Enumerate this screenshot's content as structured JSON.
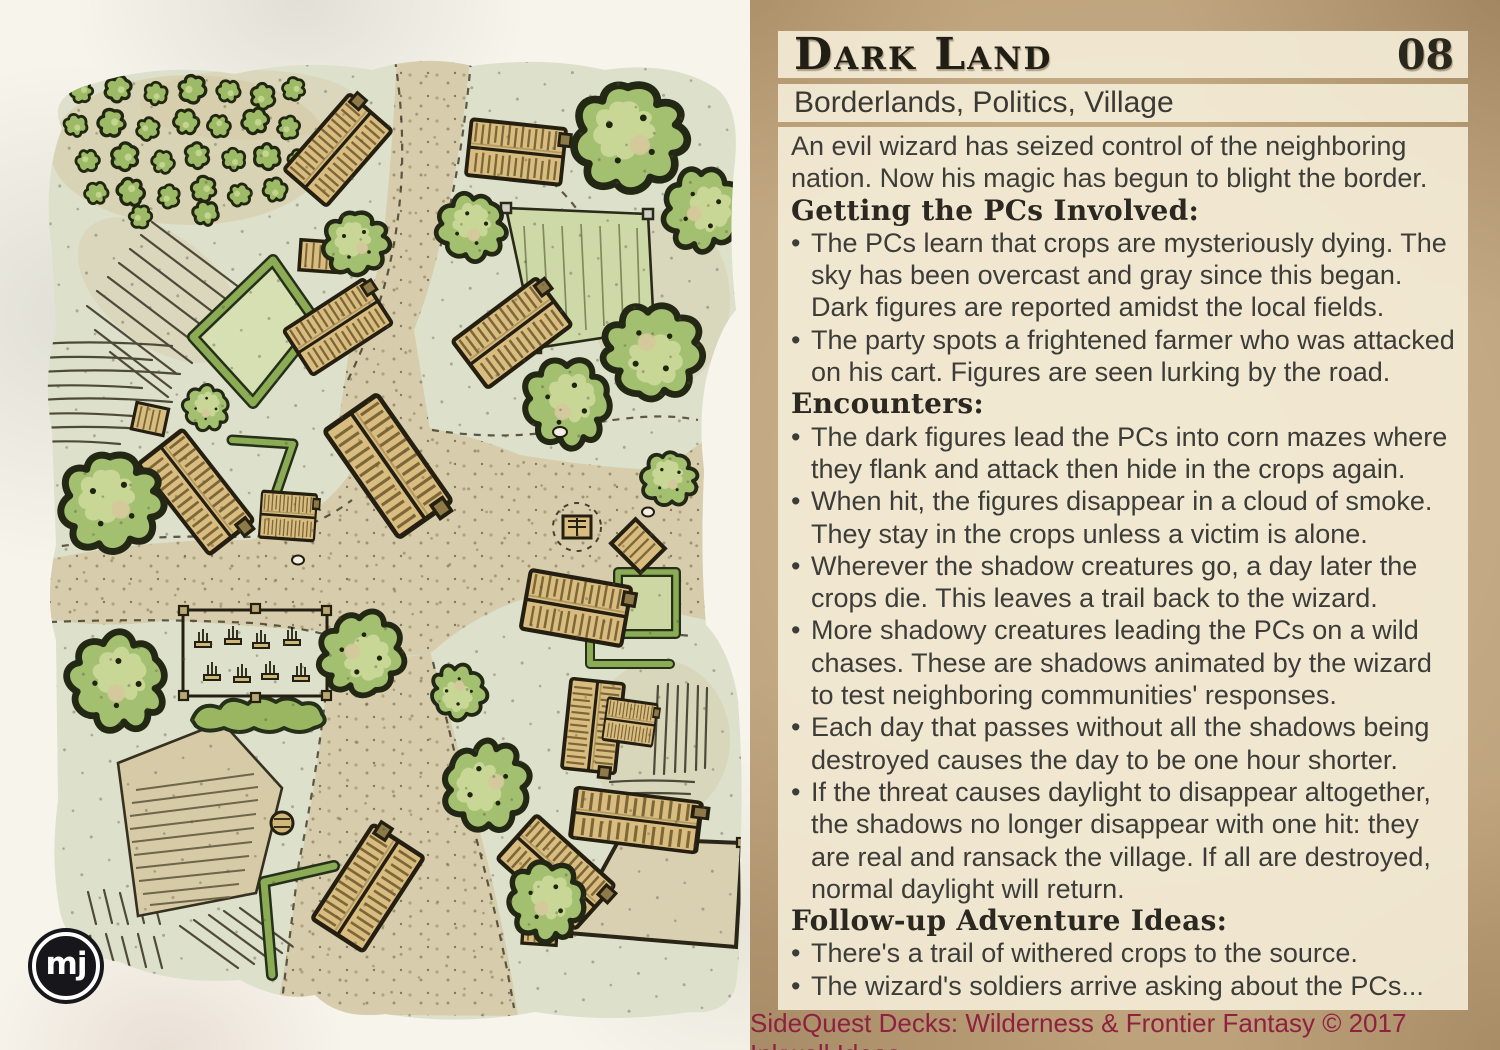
{
  "card": {
    "title": "Dark Land",
    "number": "08",
    "tags": "Borderlands, Politics, Village",
    "bullet_char": "•",
    "body": [
      {
        "type": "paragraph",
        "text": "An evil wizard has seized control of the neighboring nation. Now his magic has begun to blight the border."
      },
      {
        "type": "heading",
        "text": "Getting the PCs Involved:"
      },
      {
        "type": "bullet",
        "text": "The PCs learn that crops are mysteriously dying. The sky has been overcast and gray since this began. Dark figures are reported amidst the local fields."
      },
      {
        "type": "bullet",
        "text": "The party spots a frightened farmer who was attacked on his cart. Figures are seen lurking by the road."
      },
      {
        "type": "heading",
        "text": "Encounters:"
      },
      {
        "type": "bullet",
        "text": "The dark figures lead the PCs into corn mazes where they flank and attack then hide in the crops again."
      },
      {
        "type": "bullet",
        "text": "When hit, the figures disappear in a cloud of smoke. They stay in the crops unless a victim is alone."
      },
      {
        "type": "bullet",
        "text": "Wherever the shadow creatures go, a day later the crops die. This leaves a trail back to the wizard."
      },
      {
        "type": "bullet",
        "text": "More shadowy creatures leading the PCs on a wild chases. These are shadows animated by the wizard to test neighboring communities' responses."
      },
      {
        "type": "bullet",
        "text": "Each day that passes without all the shadows being destroyed causes the day to be one hour shorter."
      },
      {
        "type": "bullet",
        "text": "If the threat causes daylight to disappear altogether, the shadows no longer disappear with one hit: they are real and ransack the village. If all are destroyed, normal daylight will return."
      },
      {
        "type": "heading",
        "text": "Follow-up Adventure Ideas:"
      },
      {
        "type": "bullet",
        "text": "There's a trail of withered crops to the source."
      },
      {
        "type": "bullet",
        "text": "The wizard's soldiers arrive asking about the PCs..."
      }
    ],
    "footer": "SideQuest Decks: Wilderness & Frontier Fantasy © 2017 Inkwell Ideas"
  },
  "map": {
    "logo_text": "mj",
    "description": "Hand-drawn village map: orchard, fields, hedgerows, graveyard, houses, well and dirt roads"
  },
  "colors": {
    "parchment": "#bca17a",
    "text_block": "#f3ecd6",
    "body_text": "#3c3c38",
    "footer_text": "#8e2140",
    "paper": "#f7f4eb",
    "map_wash": "#dde0cb",
    "road": "#d7cdad",
    "tree": "#a3bf70",
    "building": "#d9bd80",
    "hedge": "#8cab55",
    "ink": "#262214"
  }
}
